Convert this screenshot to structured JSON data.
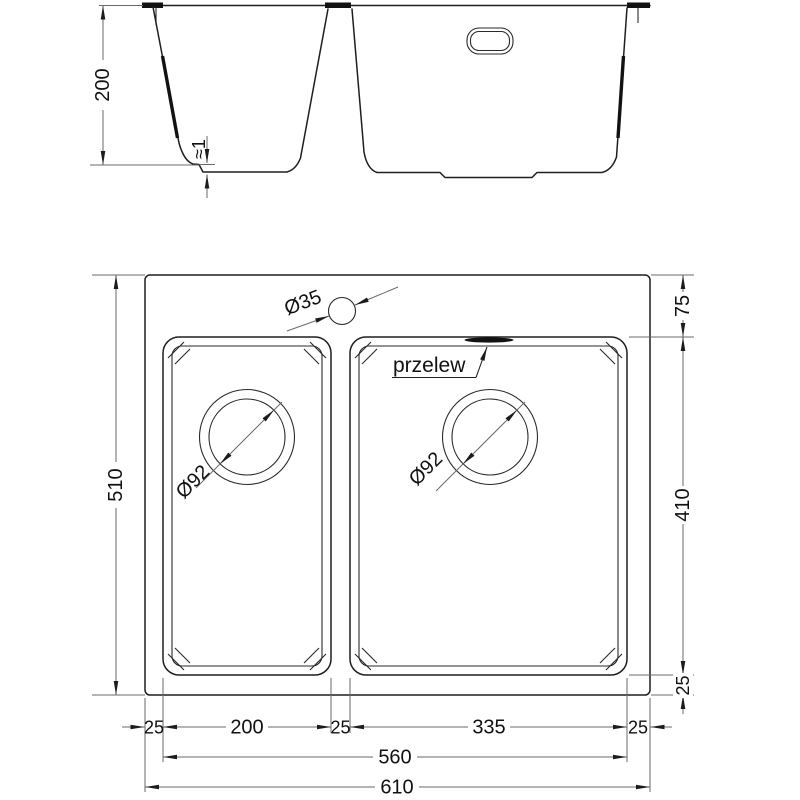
{
  "section_view": {
    "depth": "200",
    "bottom_step": "≈1"
  },
  "plan_view": {
    "overall_height": "510",
    "overall_width": "610",
    "bowls_span": "560",
    "left_edge": "25",
    "left_bowl_width": "200",
    "middle_gap": "25",
    "right_bowl_width": "335",
    "right_edge": "25",
    "top_edge": "75",
    "bowl_length": "410",
    "bottom_edge": "25",
    "faucet_hole": "Ø35",
    "left_drain": "Ø92",
    "right_drain": "Ø92",
    "overflow": "przelew"
  },
  "colors": {
    "line": "#1f1f1f",
    "dimension": "#6a6a6a",
    "text": "#111111"
  }
}
